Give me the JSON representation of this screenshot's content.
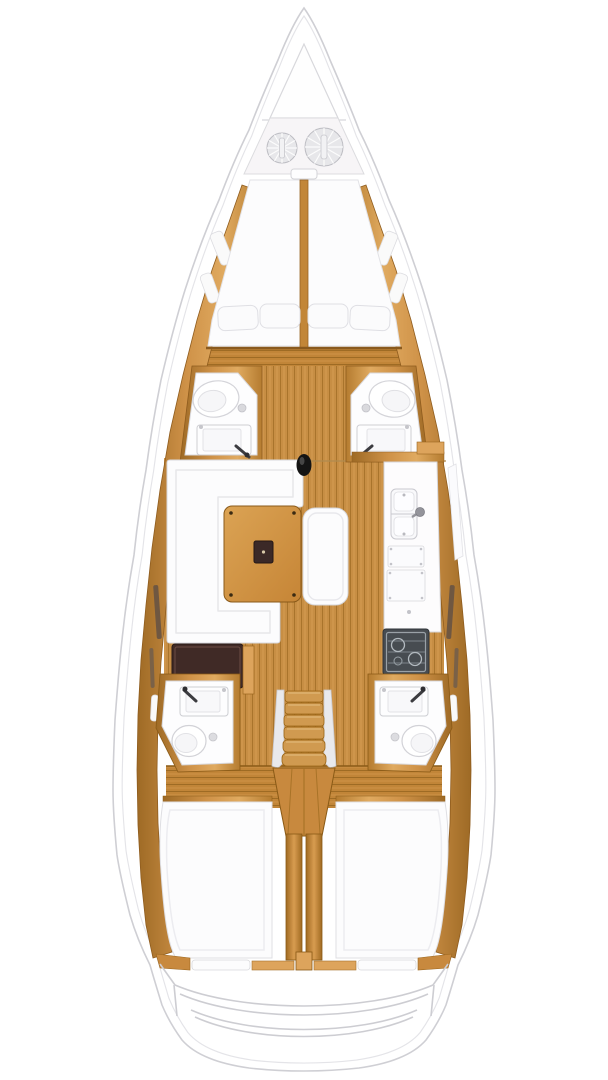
{
  "meta": {
    "description": "Top-down interior floor plan of a sailing yacht, bow up",
    "visible_text": "none"
  },
  "palette": {
    "bg": "#ffffff",
    "hull_white": "#ffffff",
    "hull_line": "#cfcfd4",
    "inner_line": "#e4e4e8",
    "wood_base": "#c8893e",
    "wood_light": "#dda45c",
    "wood_dark": "#9c671f",
    "floor_plank": "#c78e44",
    "floor_seam": "#a9742c",
    "furniture_white": "#fcfcfd",
    "furniture_line": "#d8d8dd",
    "cushion_inner": "#ececf0",
    "locker_white": "#f7f5f7",
    "chart_table_brown": "#402a26",
    "stove_dark": "#474c51",
    "stove_grate": "#9aa1a7",
    "mast_black": "#141414",
    "coil_gray": "#e7e7ea",
    "coil_line": "#bcbcc2"
  },
  "components": {
    "hull": {
      "label": "boat hull outline"
    },
    "anchor_locker": {
      "label": "bow anchor locker"
    },
    "rope_coils": {
      "label": "anchor rode coils"
    },
    "v_berth": {
      "label": "forward V-berth double bed"
    },
    "pillows": {
      "label": "V-berth pillows"
    },
    "fwd_head_port": {
      "label": "forward bathroom port side with toilet and sink"
    },
    "fwd_head_starboard": {
      "label": "forward bathroom starboard side with toilet and sink"
    },
    "mast": {
      "label": "mast post"
    },
    "settee": {
      "label": "salon L-shaped settee"
    },
    "table": {
      "label": "salon dining table with inlay"
    },
    "bench": {
      "label": "salon island bench"
    },
    "galley": {
      "label": "galley counter with double sink and lockers"
    },
    "stove": {
      "label": "galley stove with burners"
    },
    "chart_table": {
      "label": "navigation chart table"
    },
    "stairs": {
      "label": "companionway stairs"
    },
    "aft_head_port": {
      "label": "aft bathroom port side"
    },
    "aft_head_starboard": {
      "label": "aft bathroom starboard side"
    },
    "aft_berth_port": {
      "label": "aft cabin berth port side"
    },
    "aft_berth_starboard": {
      "label": "aft cabin berth starboard side"
    },
    "engine": {
      "label": "engine compartment housing"
    },
    "transom": {
      "label": "transom and cockpit bench curves"
    }
  }
}
